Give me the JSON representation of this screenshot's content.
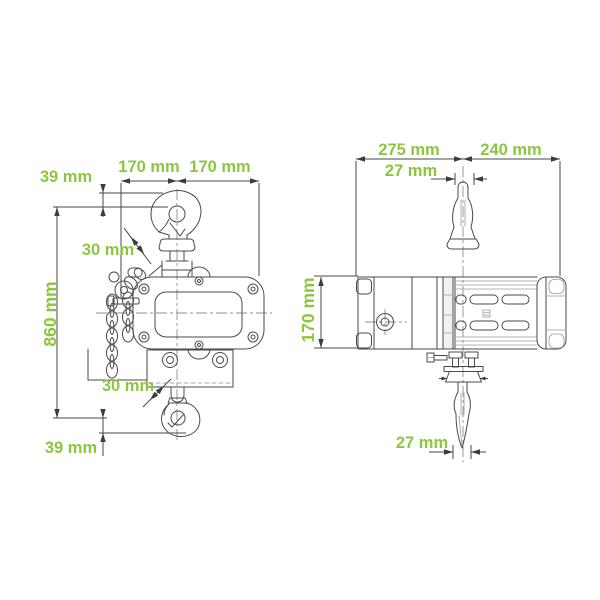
{
  "page": {
    "background": "#ffffff",
    "width_px": 600,
    "height_px": 600
  },
  "diagram": {
    "type": "technical-dimension-drawing",
    "subject": "electric chain hoist with top and bottom swivel hooks, front and side views",
    "unit": "mm",
    "accent_color": "#8CC63F",
    "line_color": "#474747",
    "views": {
      "front": {
        "title": "front view",
        "labels": {
          "top_offset": "39 mm",
          "width_left": "170 mm",
          "width_right": "170 mm",
          "top_hook_opening": "30 mm",
          "hook_to_hook": "860 mm",
          "bottom_hook_opening": "30 mm",
          "bottom_offset": "39 mm"
        }
      },
      "side": {
        "title": "side view",
        "labels": {
          "length_left": "275 mm",
          "length_right": "240 mm",
          "top_hook_width": "27 mm",
          "height": "170 mm",
          "bottom_hook_width": "27 mm"
        }
      }
    }
  }
}
